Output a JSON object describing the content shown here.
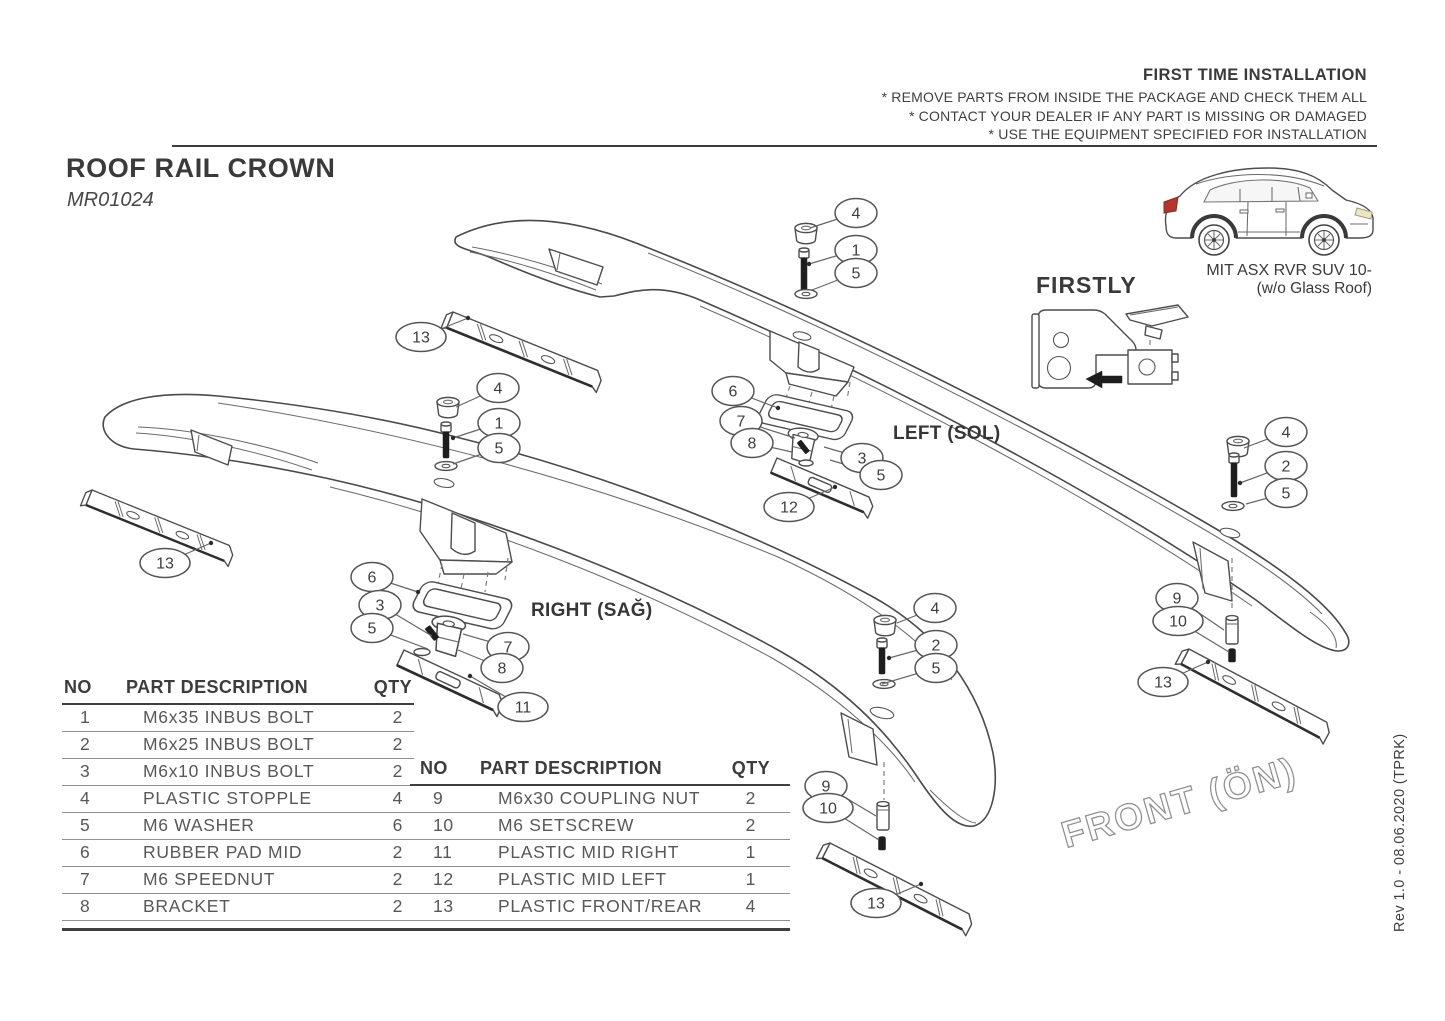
{
  "header": {
    "title": "FIRST TIME INSTALLATION",
    "notes": [
      "* REMOVE PARTS FROM INSIDE THE PACKAGE AND CHECK THEM ALL",
      "* CONTACT YOUR DEALER IF ANY PART IS MISSING OR DAMAGED",
      "* USE THE EQUIPMENT SPECIFIED FOR INSTALLATION"
    ]
  },
  "product": {
    "name": "ROOF RAIL CROWN",
    "code": "MR01024"
  },
  "vehicle": {
    "model_line1": "MIT ASX RVR SUV 10-",
    "model_line2": "(w/o Glass Roof)"
  },
  "firstly": {
    "label": "FIRSTLY"
  },
  "diagram": {
    "left_rail_label": "LEFT (SOL)",
    "right_rail_label": "RIGHT (SAĞ)",
    "front_watermark": "FRONT (ÖN)",
    "callouts": [
      {
        "label": "4",
        "x": 856,
        "y": 213,
        "tx": 810,
        "ty": 228
      },
      {
        "label": "1",
        "x": 856,
        "y": 250,
        "tx": 809,
        "ty": 264,
        "dot": true
      },
      {
        "label": "5",
        "x": 856,
        "y": 273,
        "tx": 812,
        "ty": 290
      },
      {
        "label": "13",
        "x": 421,
        "y": 337,
        "tx": 468,
        "ty": 318,
        "dot": true
      },
      {
        "label": "6",
        "x": 733,
        "y": 391,
        "tx": 778,
        "ty": 408,
        "dot": true
      },
      {
        "label": "7",
        "x": 741,
        "y": 421,
        "tx": 795,
        "ty": 438
      },
      {
        "label": "8",
        "x": 752,
        "y": 443,
        "tx": 792,
        "ty": 452
      },
      {
        "label": "3",
        "x": 862,
        "y": 458,
        "tx": 824,
        "ty": 447
      },
      {
        "label": "5",
        "x": 881,
        "y": 475,
        "tx": 830,
        "ty": 460
      },
      {
        "label": "12",
        "x": 789,
        "y": 507,
        "tx": 835,
        "ty": 487,
        "dot": true
      },
      {
        "label": "4",
        "x": 1286,
        "y": 432,
        "tx": 1244,
        "ty": 448
      },
      {
        "label": "2",
        "x": 1286,
        "y": 466,
        "tx": 1240,
        "ty": 483,
        "dot": true
      },
      {
        "label": "5",
        "x": 1286,
        "y": 493,
        "tx": 1246,
        "ty": 504
      },
      {
        "label": "9",
        "x": 1177,
        "y": 598,
        "tx": 1224,
        "ty": 630
      },
      {
        "label": "10",
        "x": 1178,
        "y": 621,
        "tx": 1229,
        "ty": 652
      },
      {
        "label": "13",
        "x": 1163,
        "y": 682,
        "tx": 1208,
        "ty": 662,
        "dot": true
      },
      {
        "label": "4",
        "x": 498,
        "y": 388,
        "tx": 456,
        "ty": 407
      },
      {
        "label": "1",
        "x": 499,
        "y": 423,
        "tx": 453,
        "ty": 438,
        "dot": true
      },
      {
        "label": "5",
        "x": 499,
        "y": 448,
        "tx": 453,
        "ty": 464
      },
      {
        "label": "13",
        "x": 165,
        "y": 563,
        "tx": 211,
        "ty": 543,
        "dot": true
      },
      {
        "label": "6",
        "x": 372,
        "y": 577,
        "tx": 418,
        "ty": 592,
        "dot": true
      },
      {
        "label": "3",
        "x": 380,
        "y": 605,
        "tx": 432,
        "ty": 636
      },
      {
        "label": "5",
        "x": 372,
        "y": 628,
        "tx": 428,
        "ty": 649
      },
      {
        "label": "7",
        "x": 508,
        "y": 647,
        "tx": 463,
        "ty": 634
      },
      {
        "label": "8",
        "x": 502,
        "y": 668,
        "tx": 458,
        "ty": 650
      },
      {
        "label": "11",
        "x": 523,
        "y": 707,
        "tx": 470,
        "ty": 676,
        "dot": true
      },
      {
        "label": "4",
        "x": 935,
        "y": 608,
        "tx": 897,
        "ty": 623
      },
      {
        "label": "2",
        "x": 936,
        "y": 645,
        "tx": 889,
        "ty": 658,
        "dot": true
      },
      {
        "label": "5",
        "x": 936,
        "y": 668,
        "tx": 882,
        "ty": 684
      },
      {
        "label": "9",
        "x": 826,
        "y": 786,
        "tx": 876,
        "ty": 816
      },
      {
        "label": "10",
        "x": 828,
        "y": 808,
        "tx": 879,
        "ty": 840
      },
      {
        "label": "13",
        "x": 876,
        "y": 903,
        "tx": 921,
        "ty": 884,
        "dot": true
      }
    ]
  },
  "tables": {
    "left": {
      "headers": [
        "NO",
        "PART DESCRIPTION",
        "QTY"
      ],
      "rows": [
        [
          "1",
          "M6x35 INBUS BOLT",
          "2"
        ],
        [
          "2",
          "M6x25 INBUS BOLT",
          "2"
        ],
        [
          "3",
          "M6x10 INBUS BOLT",
          "2"
        ],
        [
          "4",
          "PLASTIC STOPPLE",
          "4"
        ],
        [
          "5",
          "M6 WASHER",
          "6"
        ],
        [
          "6",
          "RUBBER PAD MID",
          "2"
        ],
        [
          "7",
          "M6 SPEEDNUT",
          "2"
        ],
        [
          "8",
          "BRACKET",
          "2"
        ]
      ]
    },
    "right": {
      "headers": [
        "NO",
        "PART DESCRIPTION",
        "QTY"
      ],
      "rows": [
        [
          "9",
          "M6x30 COUPLING NUT",
          "2"
        ],
        [
          "10",
          "M6 SETSCREW",
          "2"
        ],
        [
          "11",
          "PLASTIC MID RIGHT",
          "1"
        ],
        [
          "12",
          "PLASTIC MID LEFT",
          "1"
        ],
        [
          "13",
          "PLASTIC FRONT/REAR",
          "4"
        ]
      ]
    }
  },
  "revision": "Rev 1.0 - 08.06.2020 (TPRK)",
  "colors": {
    "taillight_red": "#b5342e",
    "line_gray": "#4a4a4a"
  }
}
